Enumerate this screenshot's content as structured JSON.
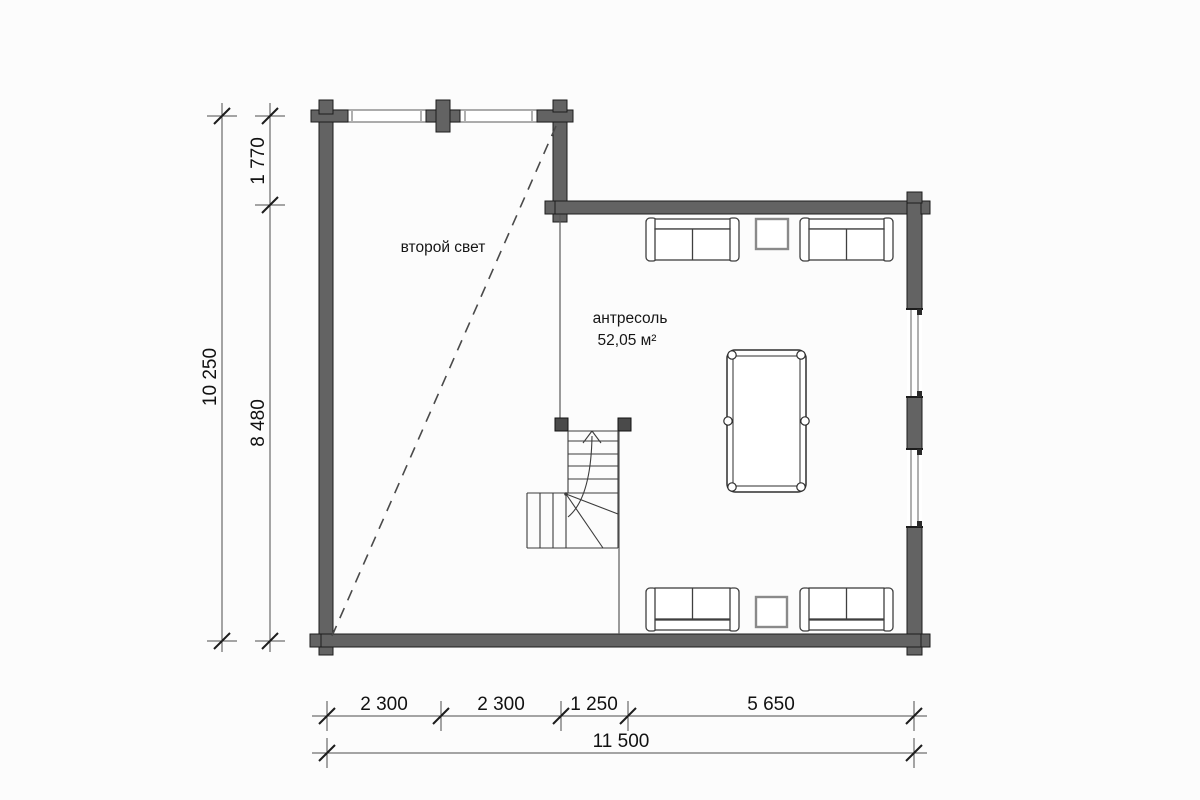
{
  "plan": {
    "room_labels": {
      "second_light": "второй свет",
      "mezzanine_name": "антресоль",
      "mezzanine_area": "52,05 м²"
    },
    "dimensions": {
      "left_outer": "10 250",
      "left_upper": "1 770",
      "left_lower": "8 480",
      "bottom_segments": [
        "2 300",
        "2 300",
        "1 250",
        "5 650"
      ],
      "bottom_total": "11 500"
    },
    "colors": {
      "wall": "#636363",
      "line": "#4c4c4c",
      "background": "#fcfcfc"
    }
  }
}
